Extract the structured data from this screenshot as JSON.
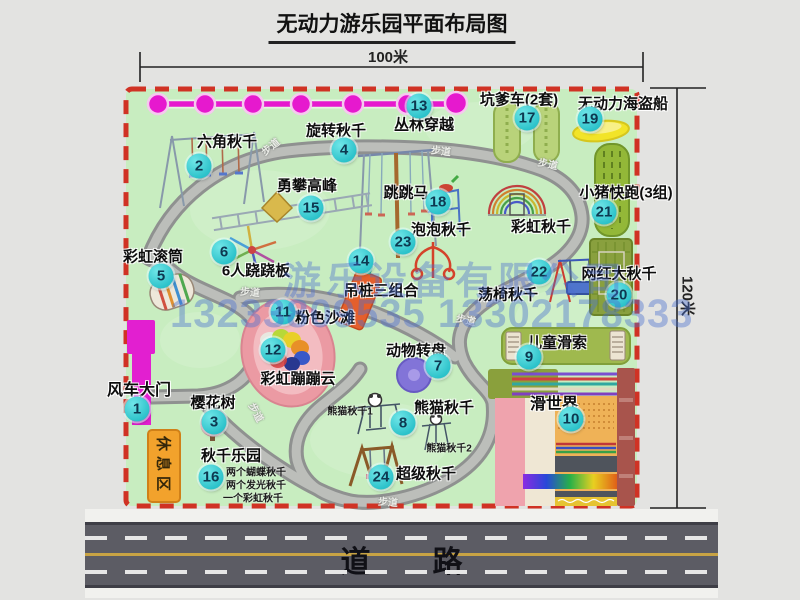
{
  "title": "无动力游乐园平面布局图",
  "dimensions": {
    "horizontal": "100米",
    "vertical": "120米"
  },
  "road_label": "道路",
  "rest_area_label": "休息区",
  "walkway_label": "步道",
  "watermark": {
    "company": "游乐设备有限公司",
    "phones": "13233809535 13302178333"
  },
  "colors": {
    "park_green": "#c8edc0",
    "border_red": "#d03224",
    "badge_cyan": "#2cc2ca",
    "gate_magenta": "#e21fd0",
    "rest_orange": "#f2a22c",
    "road_gray": "#5c5c64"
  },
  "attractions": [
    {
      "num": "1",
      "label": "风车大门",
      "lx": 139,
      "ly": 388,
      "bx": 137,
      "by": 409,
      "fs": 16
    },
    {
      "num": "2",
      "label": "六角秋千",
      "lx": 227,
      "ly": 141,
      "bx": 199,
      "by": 166
    },
    {
      "num": "3",
      "label": "樱花树",
      "lx": 213,
      "ly": 402,
      "bx": 214,
      "by": 422
    },
    {
      "num": "4",
      "label": "旋转秋千",
      "lx": 336,
      "ly": 130,
      "bx": 344,
      "by": 150
    },
    {
      "num": "5",
      "label": "彩虹滚筒",
      "lx": 153,
      "ly": 256,
      "bx": 161,
      "by": 276
    },
    {
      "num": "6",
      "label": "6人跷跷板",
      "lx": 256,
      "ly": 270,
      "bx": 224,
      "by": 252
    },
    {
      "num": "7",
      "label": "动物转盘",
      "lx": 416,
      "ly": 350,
      "bx": 438,
      "by": 366
    },
    {
      "num": "8",
      "label": "熊猫秋千",
      "lx": 444,
      "ly": 407,
      "bx": 403,
      "by": 423
    },
    {
      "num": "9",
      "label": "儿童滑索",
      "lx": 557,
      "ly": 342,
      "bx": 529,
      "by": 357
    },
    {
      "num": "10",
      "label": "滑世界",
      "lx": 554,
      "ly": 402,
      "bx": 571,
      "by": 419,
      "fs": 16
    },
    {
      "num": "11",
      "label": "粉色沙滩",
      "lx": 325,
      "ly": 317,
      "bx": 283,
      "by": 312
    },
    {
      "num": "12",
      "label": "彩虹蹦蹦云",
      "lx": 298,
      "ly": 378,
      "bx": 273,
      "by": 350
    },
    {
      "num": "13",
      "label": "丛林穿越",
      "lx": 424,
      "ly": 124,
      "bx": 419,
      "by": 106
    },
    {
      "num": "14",
      "label": "吊桩三组合",
      "lx": 381,
      "ly": 290,
      "bx": 361,
      "by": 261
    },
    {
      "num": "15",
      "label": "勇攀高峰",
      "lx": 307,
      "ly": 185,
      "bx": 311,
      "by": 208
    },
    {
      "num": "16",
      "label": "秋千乐园",
      "lx": 231,
      "ly": 455,
      "bx": 211,
      "by": 477
    },
    {
      "num": "17",
      "label": "坑爹车(2套)",
      "lx": 519,
      "ly": 99,
      "bx": 527,
      "by": 118
    },
    {
      "num": "18",
      "label": "跳跳马",
      "lx": 406,
      "ly": 192,
      "bx": 438,
      "by": 202
    },
    {
      "num": "19",
      "label": "无动力海盗船",
      "lx": 623,
      "ly": 103,
      "bx": 590,
      "by": 119
    },
    {
      "num": "20",
      "label": "网红大秋千",
      "lx": 619,
      "ly": 273,
      "bx": 619,
      "by": 295
    },
    {
      "num": "21",
      "label": "小猪快跑(3组)",
      "lx": 626,
      "ly": 192,
      "bx": 604,
      "by": 212
    },
    {
      "num": "22",
      "label": "荡椅秋千",
      "lx": 508,
      "ly": 294,
      "bx": 539,
      "by": 272
    },
    {
      "num": "23",
      "label": "泡泡秋千",
      "lx": 441,
      "ly": 229,
      "bx": 403,
      "by": 242
    },
    {
      "num": "24",
      "label": "超级秋千",
      "lx": 426,
      "ly": 473,
      "bx": 381,
      "by": 477
    },
    {
      "num": "",
      "label": "彩虹秋千",
      "lx": 541,
      "ly": 226
    }
  ],
  "sub_labels": [
    {
      "text": "熊猫秋千1",
      "x": 350,
      "y": 410
    },
    {
      "text": "熊猫秋千2",
      "x": 449,
      "y": 447
    },
    {
      "text": "两个蝴蝶秋千",
      "x": 256,
      "y": 471
    },
    {
      "text": "两个发光秋千",
      "x": 256,
      "y": 484
    },
    {
      "text": "一个彩虹秋千",
      "x": 253,
      "y": 497
    }
  ],
  "walkway_positions": [
    {
      "x": 270,
      "y": 146,
      "r": -38
    },
    {
      "x": 441,
      "y": 150,
      "r": 6
    },
    {
      "x": 548,
      "y": 163,
      "r": 12
    },
    {
      "x": 250,
      "y": 291,
      "r": 4
    },
    {
      "x": 466,
      "y": 319,
      "r": 12
    },
    {
      "x": 257,
      "y": 412,
      "r": 62
    },
    {
      "x": 388,
      "y": 501,
      "r": 4
    }
  ]
}
